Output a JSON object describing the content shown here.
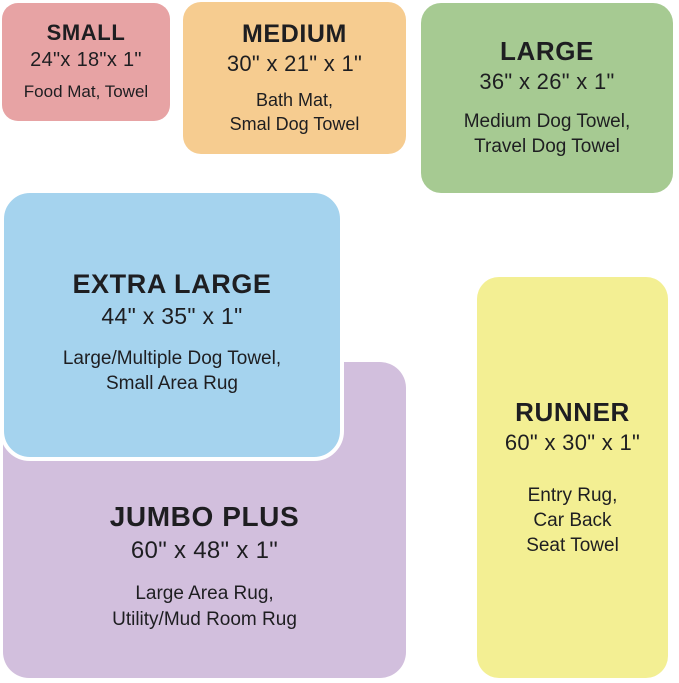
{
  "page": {
    "background_color": "#ffffff",
    "text_color": "#1e1e21",
    "description": "Size chart of mats, towels and rugs shown as proportional colored tiles"
  },
  "cards": [
    {
      "id": "small",
      "title": "SMALL",
      "dimensions": "24\"x 18\"x 1\"",
      "uses": [
        "Food Mat, Towel"
      ],
      "color": "#e7a3a4"
    },
    {
      "id": "medium",
      "title": "MEDIUM",
      "dimensions": "30\" x 21\" x 1\"",
      "uses": [
        "Bath Mat,",
        "Smal Dog Towel"
      ],
      "color": "#f6cc90"
    },
    {
      "id": "large",
      "title": "LARGE",
      "dimensions": "36\" x 26\" x 1\"",
      "uses": [
        "Medium Dog Towel,",
        "Travel Dog Towel"
      ],
      "color": "#a6ca92"
    },
    {
      "id": "extra-large",
      "title": "EXTRA LARGE",
      "dimensions": "44\" x 35\" x 1\"",
      "uses": [
        "Large/Multiple Dog Towel,",
        "Small Area Rug"
      ],
      "color": "#a5d3ee",
      "outline_color": "#ffffff"
    },
    {
      "id": "jumbo-plus",
      "title": "JUMBO PLUS",
      "dimensions": "60\" x 48\" x 1\"",
      "uses": [
        "Large Area Rug,",
        "Utility/Mud Room Rug"
      ],
      "color": "#d2bfdd"
    },
    {
      "id": "runner",
      "title": "RUNNER",
      "dimensions": "60\" x 30\" x 1\"",
      "uses": [
        "Entry Rug,",
        "Car Back",
        "Seat Towel"
      ],
      "color": "#f3ef93"
    }
  ]
}
